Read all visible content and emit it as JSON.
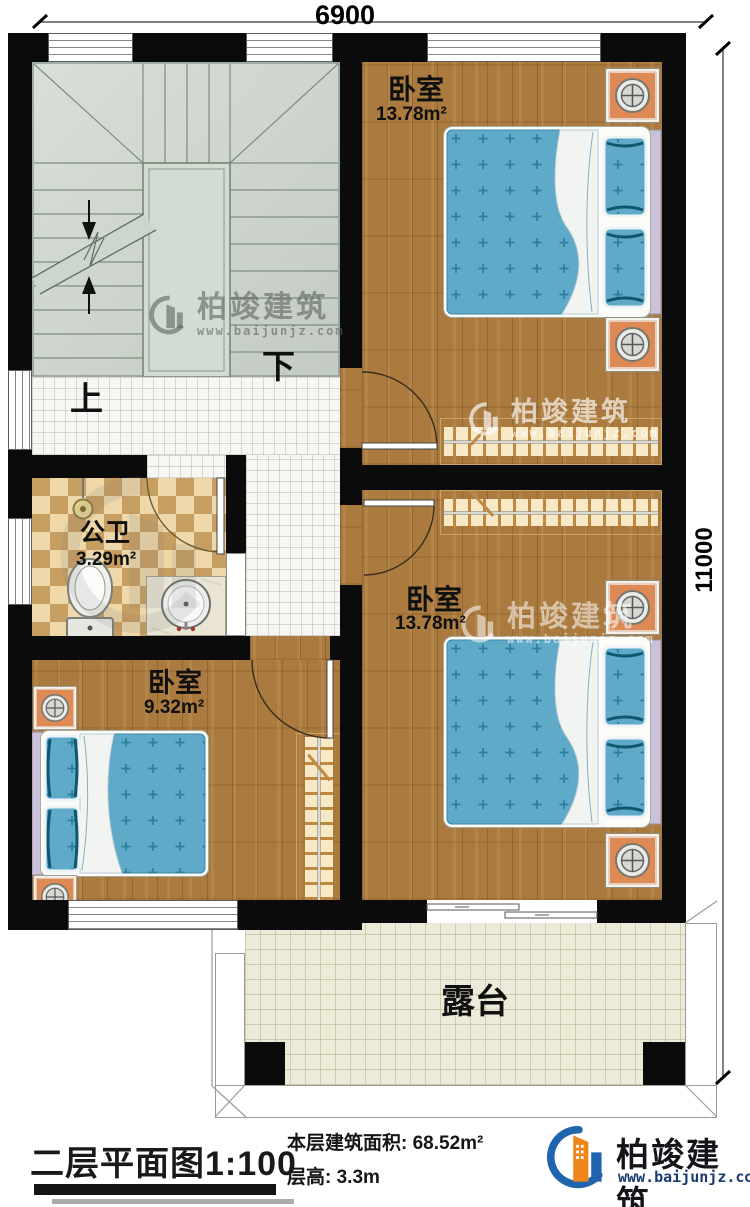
{
  "dimensions": {
    "width": "6900",
    "height": "11000"
  },
  "stairs": {
    "up_label": "上",
    "down_label": "下"
  },
  "rooms": {
    "bedroom_top": {
      "label": "卧室",
      "area": "13.78m²"
    },
    "bedroom_mid": {
      "label": "卧室",
      "area": "13.78m²"
    },
    "bedroom_small": {
      "label": "卧室",
      "area": "9.32m²"
    },
    "bathroom": {
      "label": "公卫",
      "area": "3.29m²"
    },
    "terrace": {
      "label": "露台"
    }
  },
  "watermark": {
    "brand": "柏竣建筑",
    "url": "www.baijunjz.com"
  },
  "footer": {
    "plan_title": "二层平面图",
    "plan_scale": "1:100",
    "floor_area_label": "本层建筑面积:",
    "floor_area_value": "68.52m²",
    "floor_height_label": "层高:",
    "floor_height_value": "3.3m",
    "logo_brand": "柏竣建筑",
    "logo_url": "www.baijunjz.com"
  },
  "colors": {
    "wall": "#0b0b0c",
    "wood_floor": "#aa7a3e",
    "stair_floor": "#cdd6cd",
    "bathroom_tile_light": "#eed7a8",
    "bathroom_tile_dark": "#c79e61",
    "terrace_floor": "#ecead8",
    "bed_blue": "#5fa9c9",
    "nightstand_orange": "#dd8a54",
    "logo_blue": "#1f64ad",
    "logo_orange": "#f08519"
  }
}
